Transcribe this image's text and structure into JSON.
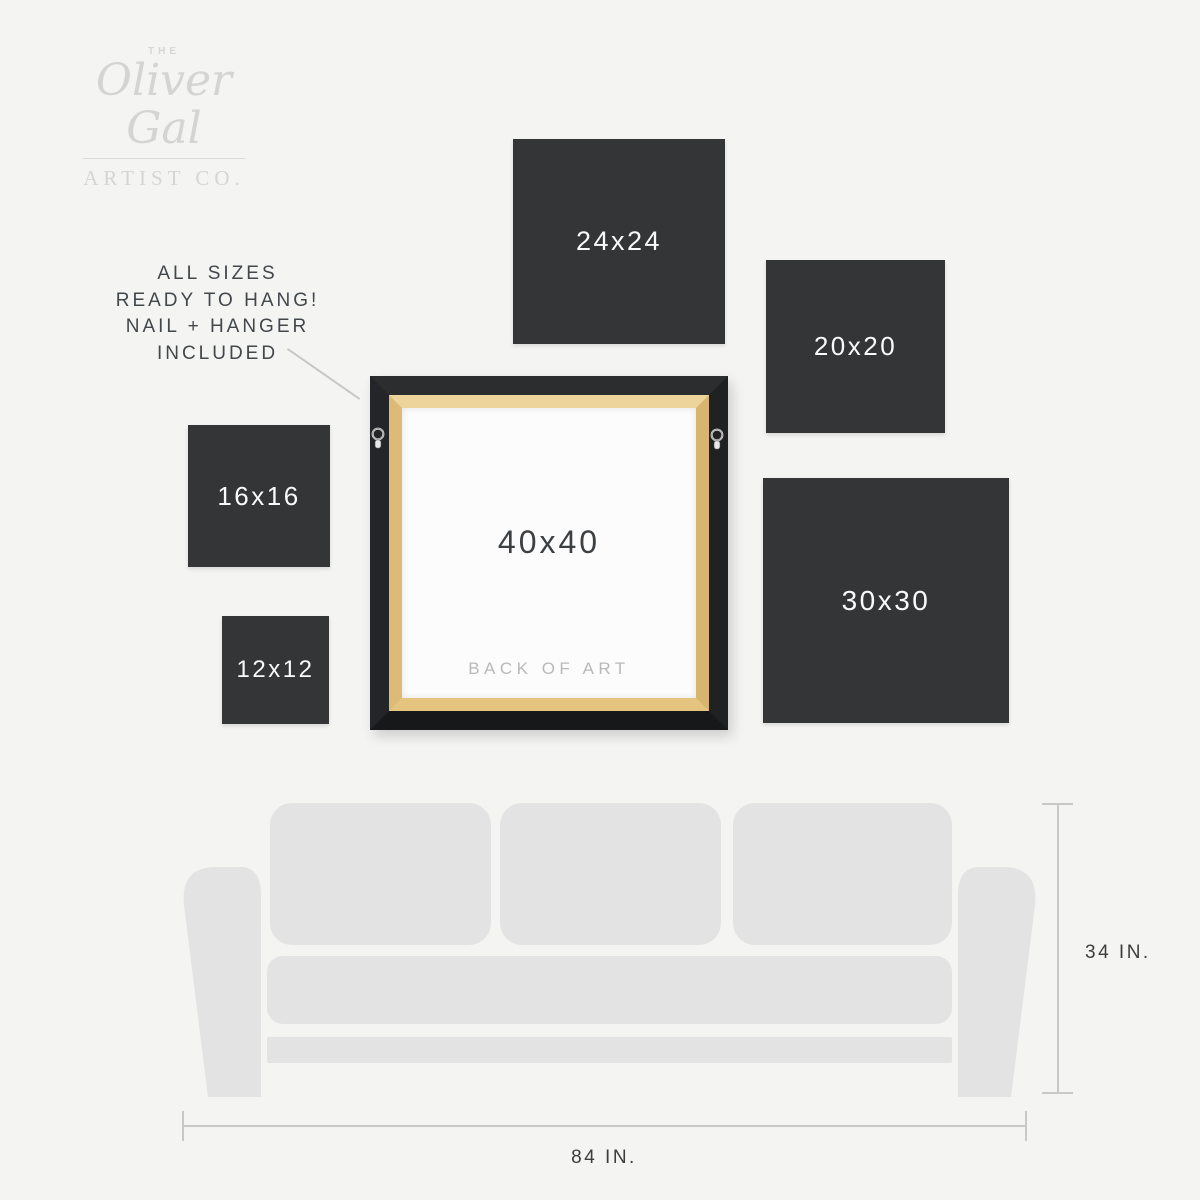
{
  "logo": {
    "the": "THE",
    "name": "Oliver Gal",
    "subtitle": "ARTIST CO."
  },
  "note": {
    "lines": [
      "ALL SIZES",
      "READY TO HANG!",
      "NAIL + HANGER",
      "INCLUDED"
    ]
  },
  "squares": [
    {
      "label": "24x24"
    },
    {
      "label": "20x20"
    },
    {
      "label": "16x16"
    },
    {
      "label": "12x12"
    },
    {
      "label": "30x30"
    }
  ],
  "frame": {
    "size_label": "40x40",
    "back_label": "BACK OF ART",
    "hanger_icon": "d-ring-hanger"
  },
  "couch": {
    "height_label": "34 IN.",
    "width_label": "84 IN."
  },
  "colors": {
    "background": "#f4f4f3",
    "swatch": "#333537",
    "swatch_text": "#fafafa",
    "couch": "#e3e3e3",
    "frame_black": "#1f2022",
    "frame_wood": "#ddbb7a",
    "canvas_back": "#fcfcfc",
    "logo_gray": "#d4d4d4",
    "note_text": "#42474b",
    "dimension_line": "#c8c8c8",
    "dimension_text": "#3d3d3d"
  }
}
